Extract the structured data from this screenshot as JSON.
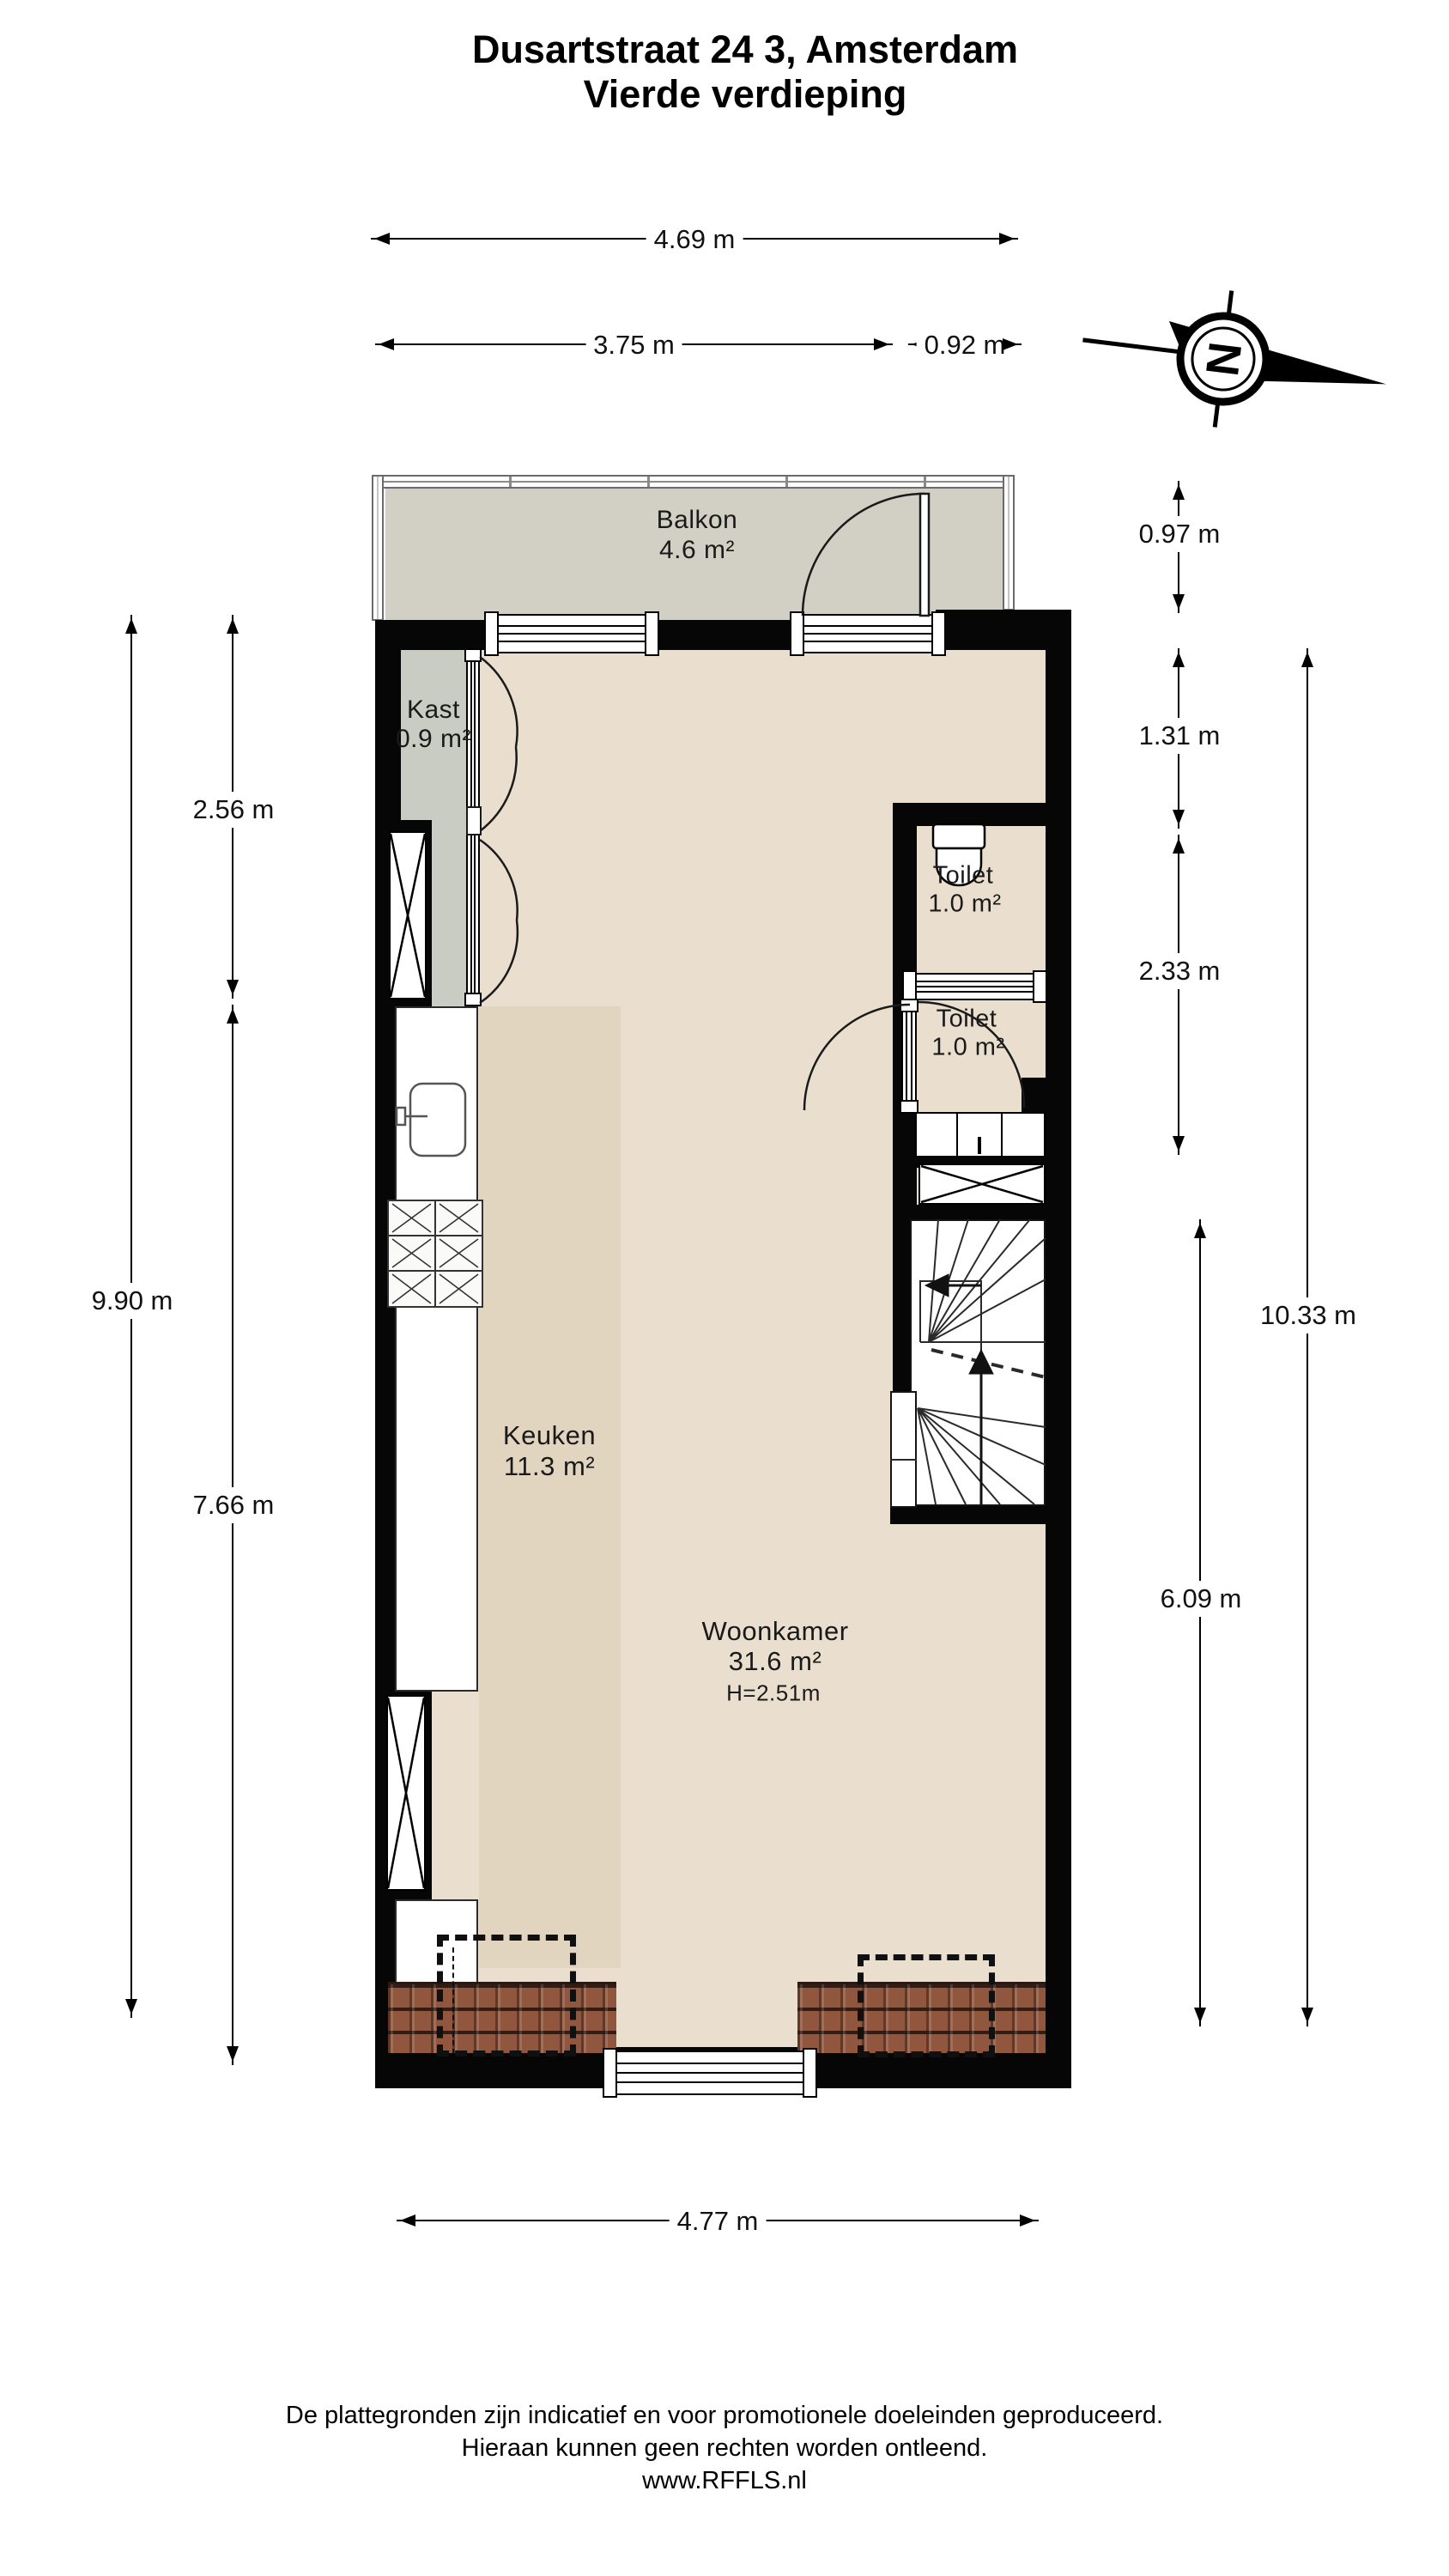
{
  "title": {
    "line1": "Dusartstraat 24 3, Amsterdam",
    "line2": "Vierde verdieping"
  },
  "compass": {
    "letter": "N"
  },
  "rooms": {
    "balkon": {
      "name": "Balkon",
      "area": "4.6 m²"
    },
    "kast": {
      "name": "Kast",
      "area": "0.9 m²"
    },
    "toilet1": {
      "name": "Toilet",
      "area": "1.0 m²"
    },
    "toilet2": {
      "name": "Toilet",
      "area": "1.0 m²"
    },
    "keuken": {
      "name": "Keuken",
      "area": "11.3 m²"
    },
    "woonkamer": {
      "name": "Woonkamer",
      "area": "31.6 m²",
      "height": "H=2.51m"
    }
  },
  "dimensions": {
    "top_total": "4.69 m",
    "top_left": "3.75 m",
    "top_right": "0.92 m",
    "left_outer": "9.90 m",
    "left_upper": "2.56 m",
    "left_lower": "7.66 m",
    "right_balcony": "0.97 m",
    "right_upper": "1.31 m",
    "right_mid": "2.33 m",
    "right_lower": "6.09 m",
    "right_total": "10.33 m",
    "bottom_total": "4.77 m"
  },
  "footer": {
    "line1": "De plattegronden zijn indicatief en voor promotionele doeleinden geproduceerd.",
    "line2": "Hieraan kunnen geen rechten worden ontleend.",
    "line3": "www.RFFLS.nl"
  },
  "colors": {
    "wall": "#060606",
    "floor": "#eadfce",
    "kitchen_floor": "#e2d5bf",
    "kast_floor": "#c9ccc2",
    "balcony_floor": "#d2d0c5",
    "roof_tiles": "#90573e"
  }
}
